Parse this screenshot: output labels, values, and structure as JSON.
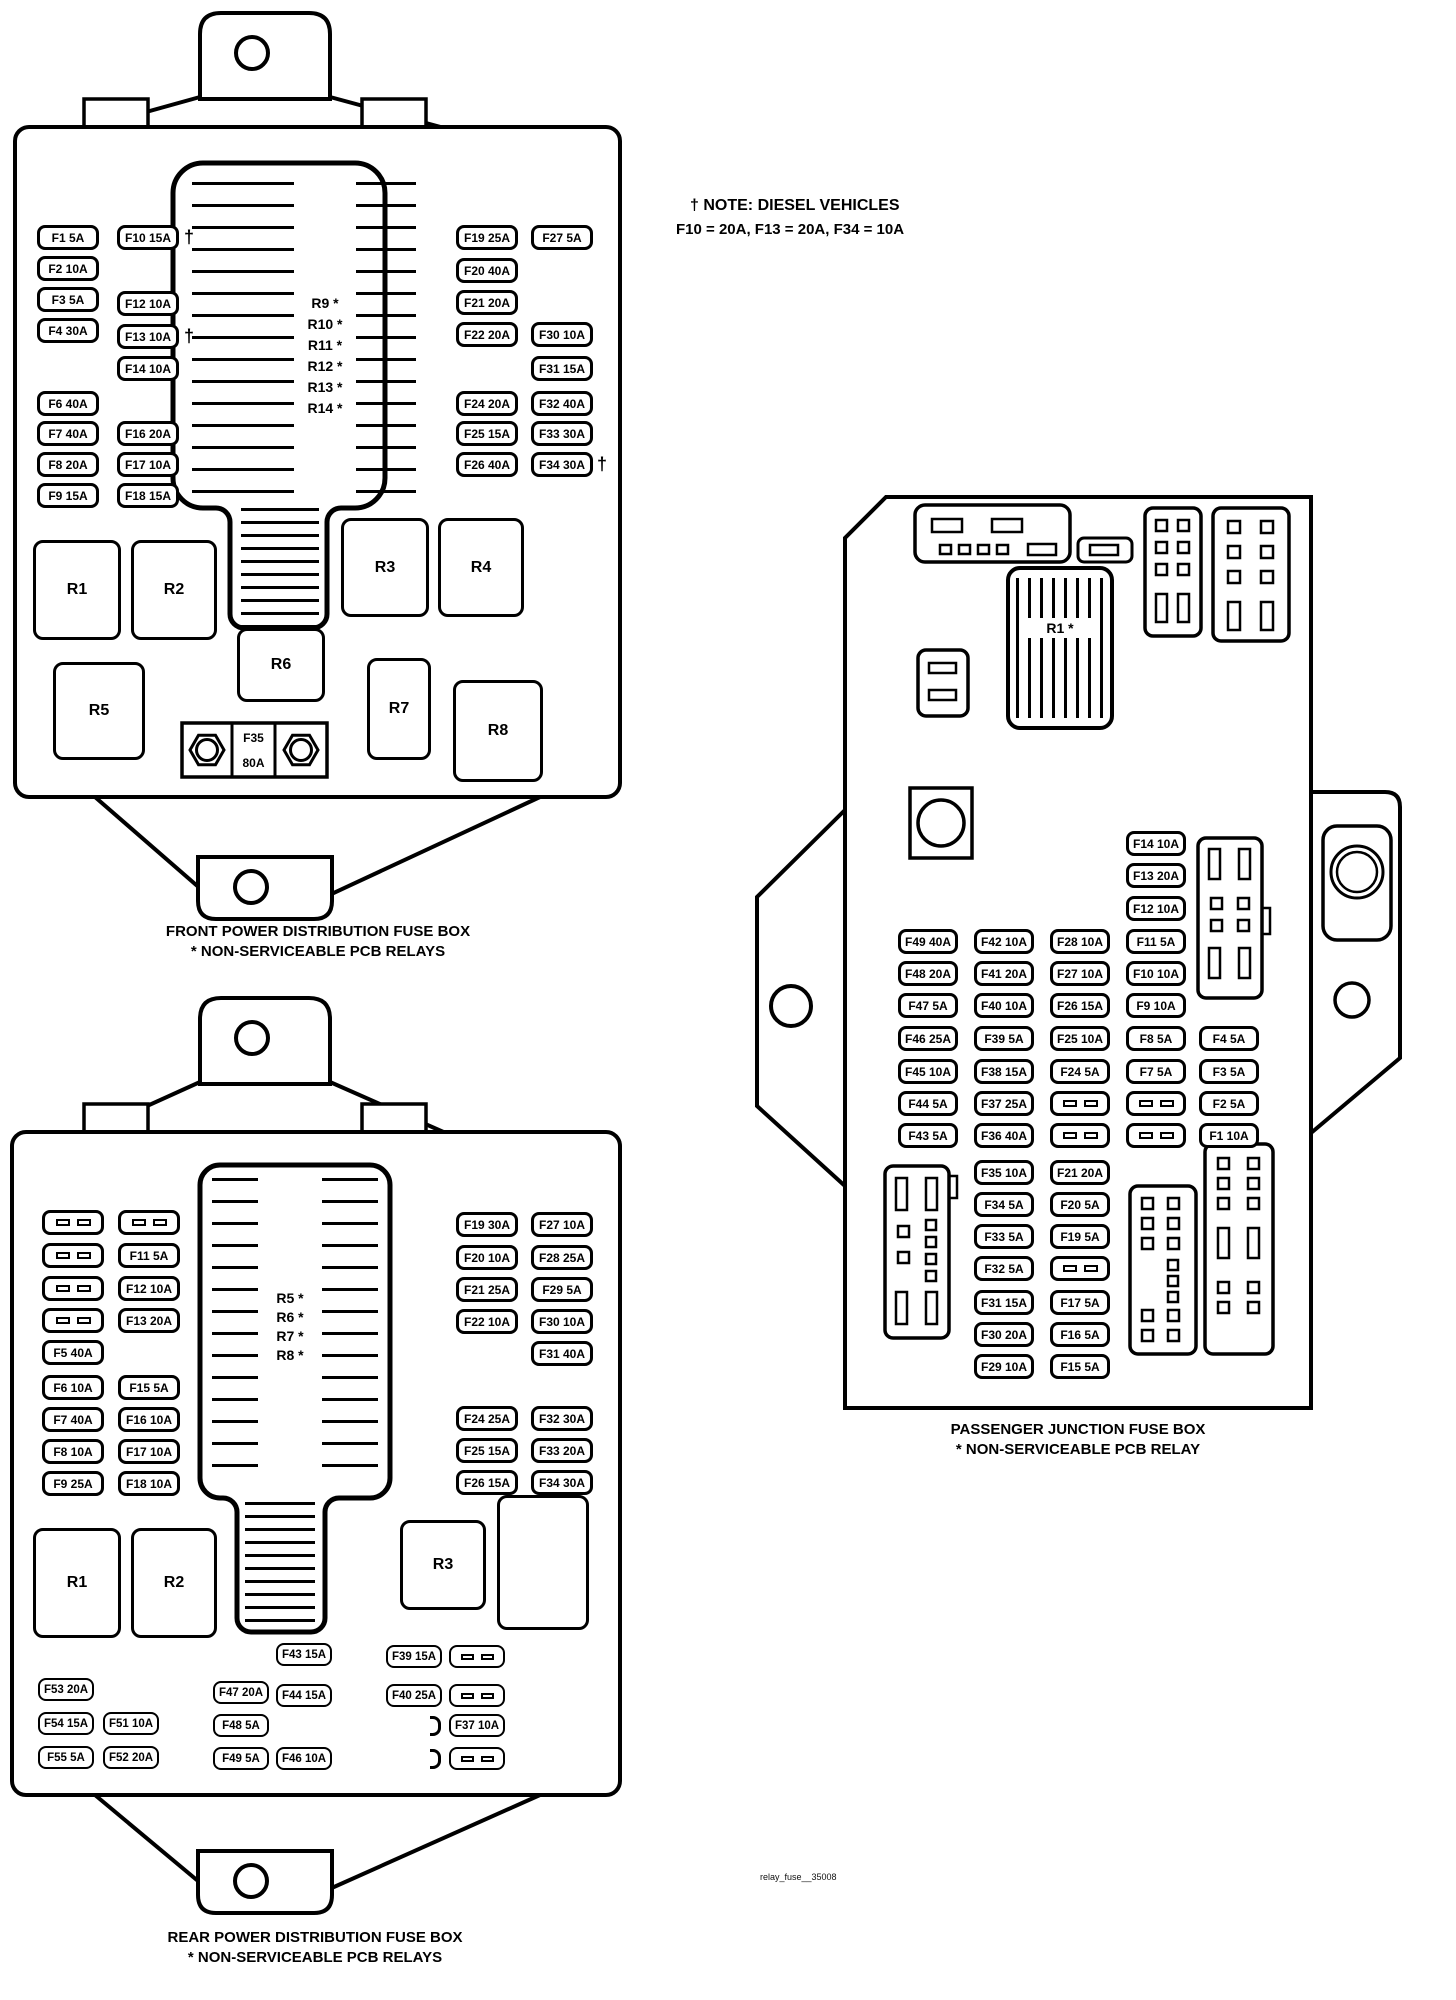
{
  "note": {
    "line1": "† NOTE: DIESEL VEHICLES",
    "line2": "F10 = 20A, F13 = 20A, F34 = 10A"
  },
  "symbols": {
    "dagger": "†"
  },
  "watermark": "relay_fuse__35008",
  "front": {
    "caption1": "FRONT POWER DISTRIBUTION FUSE BOX",
    "caption2": "* NON-SERVICEABLE PCB RELAYS",
    "fuses": {
      "f1": "F1 5A",
      "f2": "F2 10A",
      "f3": "F3 5A",
      "f4": "F4 30A",
      "f6": "F6 40A",
      "f7": "F7 40A",
      "f8": "F8 20A",
      "f9": "F9 15A",
      "f10": "F10 15A",
      "f12": "F12 10A",
      "f13": "F13 10A",
      "f14": "F14 10A",
      "f16": "F16 20A",
      "f17": "F17 10A",
      "f18": "F18 15A",
      "f19": "F19 25A",
      "f20": "F20 40A",
      "f21": "F21 20A",
      "f22": "F22 20A",
      "f24": "F24 20A",
      "f25": "F25 15A",
      "f26": "F26 40A",
      "f27": "F27 5A",
      "f30": "F30 10A",
      "f31": "F31 15A",
      "f32": "F32 40A",
      "f33": "F33 30A",
      "f34": "F34 30A"
    },
    "f35": {
      "id": "F35",
      "amp": "80A"
    },
    "relays": {
      "r1": "R1",
      "r2": "R2",
      "r3": "R3",
      "r4": "R4",
      "r5": "R5",
      "r6": "R6",
      "r7": "R7",
      "r8": "R8"
    },
    "pcb_relays": [
      "R9 *",
      "R10 *",
      "R11 *",
      "R12 *",
      "R13 *",
      "R14 *"
    ]
  },
  "rear": {
    "caption1": "REAR POWER DISTRIBUTION FUSE BOX",
    "caption2": "* NON-SERVICEABLE PCB RELAYS",
    "fuses": {
      "f5": "F5 40A",
      "f6": "F6 10A",
      "f7": "F7 40A",
      "f8": "F8 10A",
      "f9": "F9 25A",
      "f11": "F11 5A",
      "f12": "F12 10A",
      "f13": "F13 20A",
      "f15": "F15 5A",
      "f16": "F16 10A",
      "f17": "F17 10A",
      "f18": "F18 10A",
      "f19": "F19 30A",
      "f20": "F20 10A",
      "f21": "F21 25A",
      "f22": "F22 10A",
      "f24": "F24 25A",
      "f25": "F25 15A",
      "f26": "F26 15A",
      "f27": "F27 10A",
      "f28": "F28 25A",
      "f29": "F29 5A",
      "f30": "F30 10A",
      "f31": "F31 40A",
      "f32": "F32 30A",
      "f33": "F33 20A",
      "f34": "F34 30A",
      "f37": "F37 10A",
      "f39": "F39 15A",
      "f40": "F40 25A",
      "f43": "F43 15A",
      "f44": "F44 15A",
      "f46": "F46 10A",
      "f47": "F47 20A",
      "f48": "F48 5A",
      "f49": "F49 5A",
      "f51": "F51 10A",
      "f52": "F52 20A",
      "f53": "F53 20A",
      "f54": "F54 15A",
      "f55": "F55 5A"
    },
    "relays": {
      "r1": "R1",
      "r2": "R2",
      "r3": "R3"
    },
    "pcb_relays": [
      "R5 *",
      "R6 *",
      "R7 *",
      "R8 *"
    ]
  },
  "passenger": {
    "caption1": "PASSENGER JUNCTION FUSE BOX",
    "caption2": "* NON-SERVICEABLE PCB RELAY",
    "pcb_relay": "R1 *",
    "fuses": {
      "f49": "F49 40A",
      "f48": "F48 20A",
      "f47": "F47 5A",
      "f46": "F46 25A",
      "f45": "F45 10A",
      "f44": "F44 5A",
      "f43": "F43 5A",
      "f42": "F42 10A",
      "f41": "F41 20A",
      "f40": "F40 10A",
      "f39": "F39 5A",
      "f38": "F38 15A",
      "f37": "F37 25A",
      "f36": "F36 40A",
      "f35": "F35 10A",
      "f34": "F34 5A",
      "f33": "F33 5A",
      "f32": "F32 5A",
      "f31": "F31 15A",
      "f30": "F30 20A",
      "f29": "F29 10A",
      "f28": "F28 10A",
      "f27": "F27 10A",
      "f26": "F26 15A",
      "f25": "F25 10A",
      "f24": "F24 5A",
      "f21": "F21 20A",
      "f20": "F20 5A",
      "f19": "F19 5A",
      "f17": "F17 5A",
      "f16": "F16 5A",
      "f15": "F15 5A",
      "f14": "F14 10A",
      "f13": "F13 20A",
      "f12": "F12 10A",
      "f11": "F11 5A",
      "f10": "F10 10A",
      "f9": "F9 10A",
      "f8": "F8 5A",
      "f7": "F7 5A",
      "f4": "F4 5A",
      "f3": "F3 5A",
      "f2": "F2 5A",
      "f1": "F1 10A"
    }
  }
}
